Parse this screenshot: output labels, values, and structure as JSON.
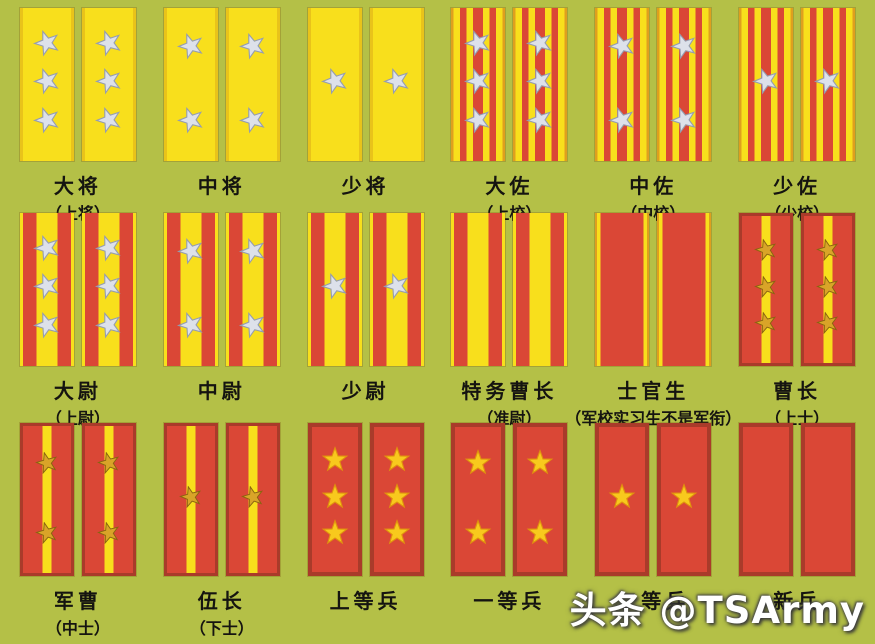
{
  "page": {
    "watermark": "头条 @TSArmy"
  },
  "colors": {
    "bg": "#b4c047",
    "tab_yellow": "#f8df1c",
    "tab_red": "#da4736",
    "edge_gold": "#df9f1e",
    "edge_yellow_dark": "#e9c31a",
    "border_red": "#a93b2a",
    "star_silver": "#dde1ea",
    "star_silver_edge": "#959db0",
    "star_gold": "#d9a428",
    "star_gold_edge": "#8a6410",
    "star_bright": "#f8c91d",
    "star_bright_edge": "#e0920e",
    "label": "#151410"
  },
  "rows": [
    {
      "ranks": [
        {
          "name": "大将",
          "alt": "（上将）",
          "tab_style": "general",
          "stars": 3,
          "star_color": "silver"
        },
        {
          "name": "中将",
          "alt": "",
          "tab_style": "general",
          "stars": 2,
          "star_color": "silver"
        },
        {
          "name": "少将",
          "alt": "",
          "tab_style": "general",
          "stars": 1,
          "star_color": "silver"
        },
        {
          "name": "大佐",
          "alt": "（上校）",
          "tab_style": "field",
          "stars": 3,
          "star_color": "silver"
        },
        {
          "name": "中佐",
          "alt": "（中校）",
          "tab_style": "field",
          "stars": 2,
          "star_color": "silver"
        },
        {
          "name": "少佐",
          "alt": "（少校）",
          "tab_style": "field",
          "stars": 1,
          "star_color": "silver"
        }
      ]
    },
    {
      "ranks": [
        {
          "name": "大尉",
          "alt": "（上尉）",
          "tab_style": "company",
          "stars": 3,
          "star_color": "silver"
        },
        {
          "name": "中尉",
          "alt": "",
          "tab_style": "company",
          "stars": 2,
          "star_color": "silver"
        },
        {
          "name": "少尉",
          "alt": "",
          "tab_style": "company",
          "stars": 1,
          "star_color": "silver"
        },
        {
          "name": "特务曹长",
          "alt": "（准尉）",
          "tab_style": "company",
          "stars": 0,
          "star_color": "silver"
        },
        {
          "name": "士官生",
          "alt": "（军校实习生不是军衔）",
          "tab_style": "cadet",
          "stars": 0,
          "star_color": "silver"
        },
        {
          "name": "曹长",
          "alt": "（上士）",
          "tab_style": "nco",
          "stars": 3,
          "star_color": "gold"
        }
      ]
    },
    {
      "ranks": [
        {
          "name": "军曹",
          "alt": "（中士）",
          "tab_style": "nco",
          "stars": 2,
          "star_color": "gold"
        },
        {
          "name": "伍长",
          "alt": "（下士）",
          "tab_style": "nco",
          "stars": 1,
          "star_color": "gold"
        },
        {
          "name": "上等兵",
          "alt": "",
          "tab_style": "soldier",
          "stars": 3,
          "star_color": "bright"
        },
        {
          "name": "一等兵",
          "alt": "",
          "tab_style": "soldier",
          "stars": 2,
          "star_color": "bright"
        },
        {
          "name": "二等兵",
          "alt": "",
          "tab_style": "soldier",
          "stars": 1,
          "star_color": "bright"
        },
        {
          "name": "新兵",
          "alt": "",
          "tab_style": "soldier",
          "stars": 0,
          "star_color": "bright"
        }
      ]
    }
  ]
}
